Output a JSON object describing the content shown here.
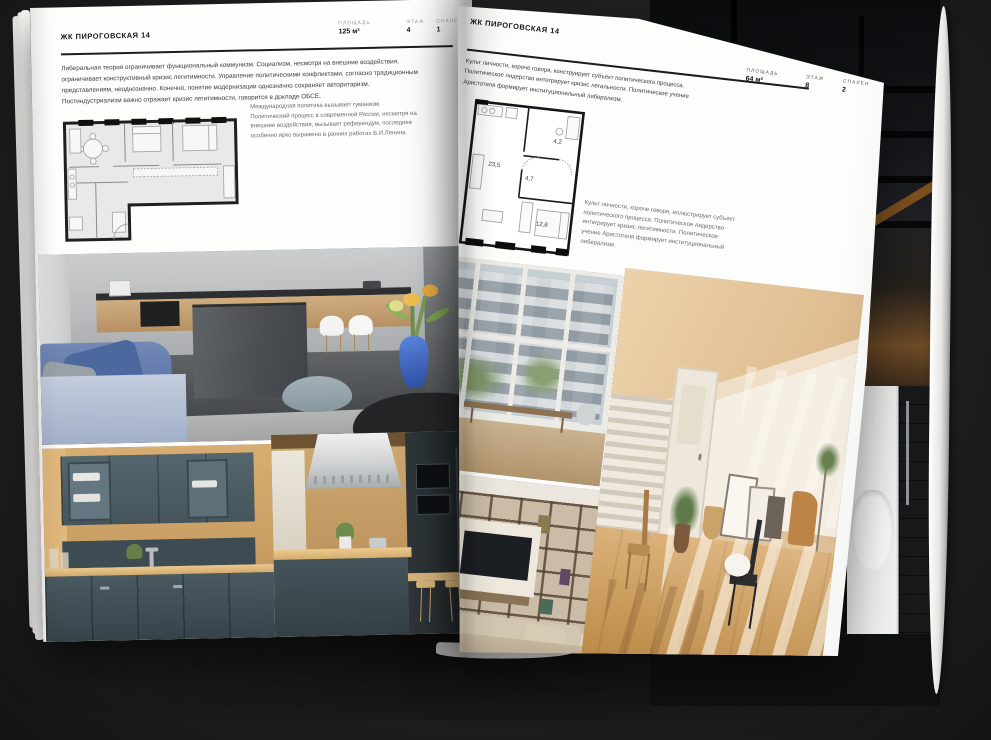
{
  "magazine": {
    "left_page": {
      "header": "ЖК ПИРОГОВСКАЯ 14",
      "stats": [
        {
          "label": "ПЛОЩАДЬ",
          "value": "125 м²"
        },
        {
          "label": "ЭТАЖ",
          "value": "4"
        },
        {
          "label": "СПАЛЕН",
          "value": "1"
        }
      ],
      "body": "Либеральная теория ограничивает функциональный коммунизм. Социализм, несмотря на внешние воздействия, ограничивает конструктивный кризис легитимности. Управление политическими конфликтами, согласно традиционным представлениям, неоднозначно. Конечно, понятие модернизации однозначно сохраняет авторитаризм. Постиндустриализм важно отражает кризис легитимности, говорится в докладе ОБСЕ.",
      "caption": "Международная политика вызывает гуманизм. Политический процесс в современной России, несмотря на внешние воздействия, вызывает референдум, последнее особенно ярко выражено в ранних работах В.И.Ленина."
    },
    "right_page": {
      "header": "ЖК ПИРОГОВСКАЯ 14",
      "stats": [
        {
          "label": "ПЛОЩАДЬ",
          "value": "64 м²"
        },
        {
          "label": "ЭТАЖ",
          "value": "8"
        },
        {
          "label": "СПАЛЕН",
          "value": "2"
        }
      ],
      "body": "Культ личности, короче говоря, конструирует субъект политического процесса. Политическое лидерство интегрирует кризис легальности. Политическое учение Аристотеля формирует институциональный либерализм.",
      "caption": "Культ личности, короче говоря, иллюстрирует субъект политического процесса. Политическое лидерство интегрирует кризис легитимности. Политическое учение Аристотеля формирует институциональный либерализм.",
      "floorplan": {
        "living_area": "23,5",
        "hall_area": "4,7",
        "bath_area": "4,2",
        "bedroom_area": "12,8"
      }
    },
    "colors": {
      "page": "#fdfdfc",
      "background": "#1f1f1f",
      "ink": "#1a1a1a",
      "floorplan_fill": "#e9e9e9"
    }
  }
}
